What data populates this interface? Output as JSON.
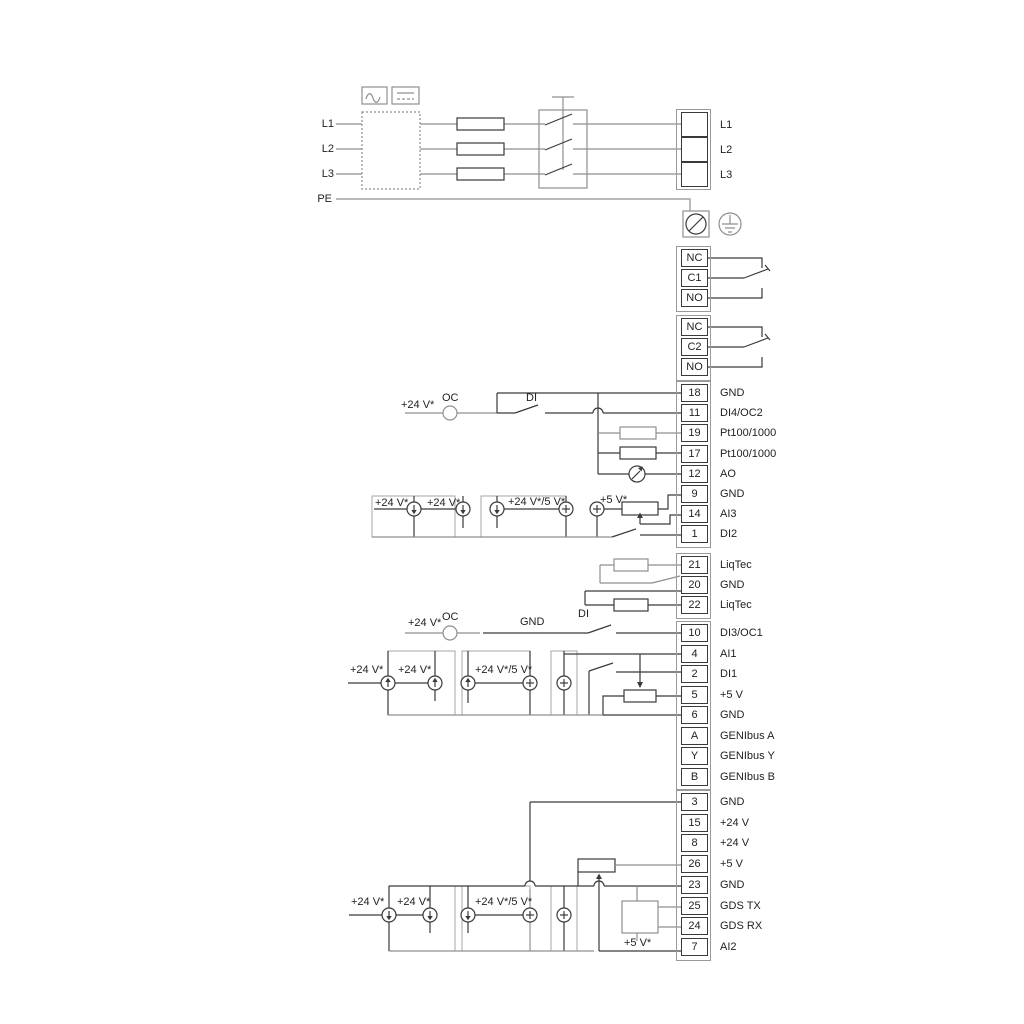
{
  "power": {
    "inputs": {
      "l1": "L1",
      "l2": "L2",
      "l3": "L3",
      "pe": "PE"
    }
  },
  "strips": {
    "power_out": [
      {
        "num": "",
        "label": "L1"
      },
      {
        "num": "",
        "label": "L2"
      },
      {
        "num": "",
        "label": "L3"
      }
    ],
    "relay1": [
      {
        "num": "NC",
        "label": ""
      },
      {
        "num": "C1",
        "label": ""
      },
      {
        "num": "NO",
        "label": ""
      }
    ],
    "relay2": [
      {
        "num": "NC",
        "label": ""
      },
      {
        "num": "C2",
        "label": ""
      },
      {
        "num": "NO",
        "label": ""
      }
    ],
    "io_top": [
      {
        "num": "18",
        "label": "GND"
      },
      {
        "num": "11",
        "label": "DI4/OC2"
      },
      {
        "num": "19",
        "label": "Pt100/1000"
      },
      {
        "num": "17",
        "label": "Pt100/1000"
      },
      {
        "num": "12",
        "label": "AO"
      },
      {
        "num": "9",
        "label": "GND"
      },
      {
        "num": "14",
        "label": "AI3"
      },
      {
        "num": "1",
        "label": "DI2"
      }
    ],
    "liqtec": [
      {
        "num": "21",
        "label": "LiqTec"
      },
      {
        "num": "20",
        "label": "GND"
      },
      {
        "num": "22",
        "label": "LiqTec"
      }
    ],
    "io_mid": [
      {
        "num": "10",
        "label": "DI3/OC1"
      },
      {
        "num": "4",
        "label": "AI1"
      },
      {
        "num": "2",
        "label": "DI1"
      },
      {
        "num": "5",
        "label": "+5 V"
      },
      {
        "num": "6",
        "label": "GND"
      },
      {
        "num": "A",
        "label": "GENIbus A"
      },
      {
        "num": "Y",
        "label": "GENIbus Y"
      },
      {
        "num": "B",
        "label": "GENIbus B"
      }
    ],
    "io_bottom": [
      {
        "num": "3",
        "label": "GND"
      },
      {
        "num": "15",
        "label": "+24 V"
      },
      {
        "num": "8",
        "label": "+24 V"
      },
      {
        "num": "26",
        "label": "+5 V"
      },
      {
        "num": "23",
        "label": "GND"
      },
      {
        "num": "25",
        "label": "GDS TX"
      },
      {
        "num": "24",
        "label": "GDS RX"
      },
      {
        "num": "7",
        "label": "AI2"
      }
    ]
  },
  "wire": {
    "plus24": "+24 V*",
    "plus24or5": "+24 V*/5 V*",
    "plus5": "+5 V*",
    "oc": "OC",
    "di": "DI",
    "gnd": "GND"
  }
}
